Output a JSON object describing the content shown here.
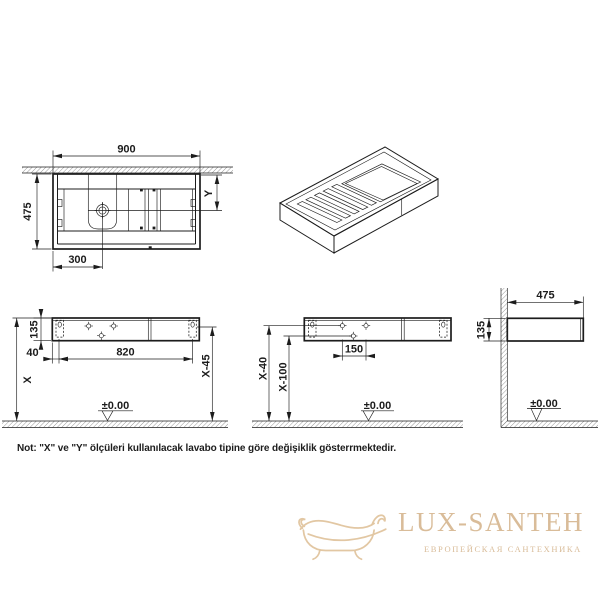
{
  "views": {
    "top": {
      "width": "900",
      "depth": "475",
      "drain_offset": "300",
      "drain_y": "Y"
    },
    "front_a": {
      "height": "135",
      "bracket_offset": "40",
      "bracket_span": "820",
      "top_height": "X",
      "bracket_height": "X-45",
      "floor_datum": "±0.00"
    },
    "front_b": {
      "faucet_span": "150",
      "upper_holes": "X-40",
      "lower_hole": "X-100",
      "floor_datum": "±0.00"
    },
    "side": {
      "depth": "475",
      "height": "135",
      "floor_datum": "±0.00"
    }
  },
  "note": "Not: \"X\" ve \"Y\" ölçüleri kullanılacak lavabo tipine göre değişiklik gösterrmektedir.",
  "logo": {
    "brand": "LUX-SANTEH",
    "tagline": "ЕВРОПЕЙСКАЯ САНТЕХНИКА"
  },
  "colors": {
    "line": "#1c1c1c",
    "logo_text": "#d9bc99",
    "logo_icon": "#e2c7a3"
  }
}
